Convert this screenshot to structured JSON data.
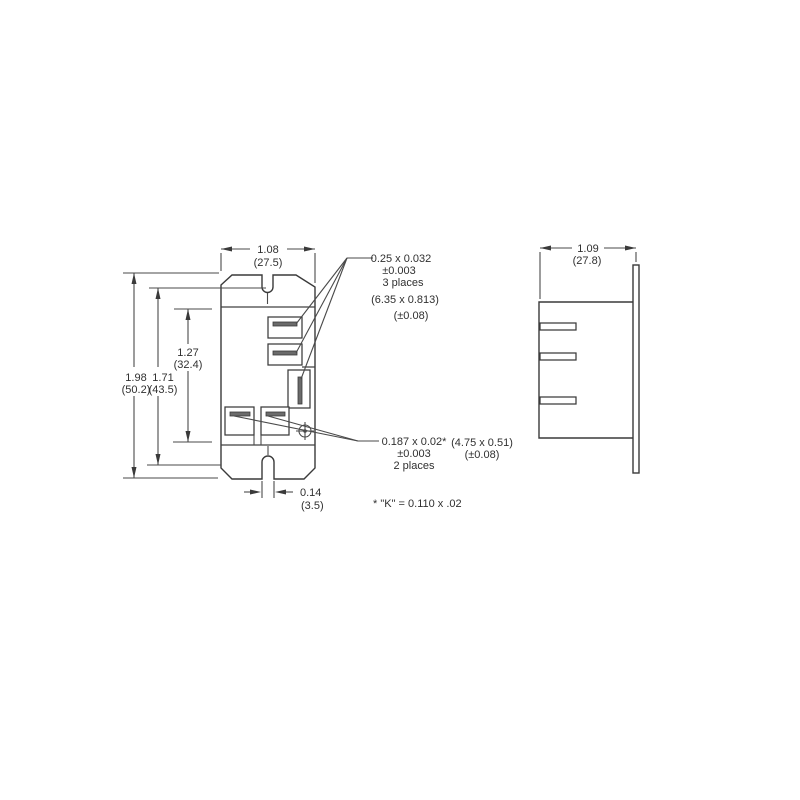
{
  "colors": {
    "line": "#414141",
    "text": "#303030",
    "blade_fill": "#6b6b6b",
    "background": "#ffffff"
  },
  "front": {
    "dim_width": {
      "in": "1.08",
      "mm": "(27.5)"
    },
    "dim_overall": {
      "in": "1.98",
      "mm": "(50.2)"
    },
    "dim_body": {
      "in": "1.71",
      "mm": "(43.5)"
    },
    "dim_terminal": {
      "in": "1.27",
      "mm": "(32.4)"
    },
    "dim_notch": {
      "in": "0.14",
      "mm": "(3.5)"
    }
  },
  "side": {
    "dim_width": {
      "in": "1.09",
      "mm": "(27.8)"
    }
  },
  "callout_blades_3": {
    "size": "0.25 x 0.032",
    "tol": "±0.003",
    "places": "3 places",
    "metric_size": "(6.35 x 0.813)",
    "metric_tol": "(±0.08)"
  },
  "callout_blades_2": {
    "size": "0.187 x 0.02*",
    "tol": "±0.003",
    "places": "2 places",
    "metric_size": "(4.75 x 0.51)",
    "metric_tol": "(±0.08)"
  },
  "footnote": {
    "text": "* \"K\" = 0.110 x .02"
  }
}
